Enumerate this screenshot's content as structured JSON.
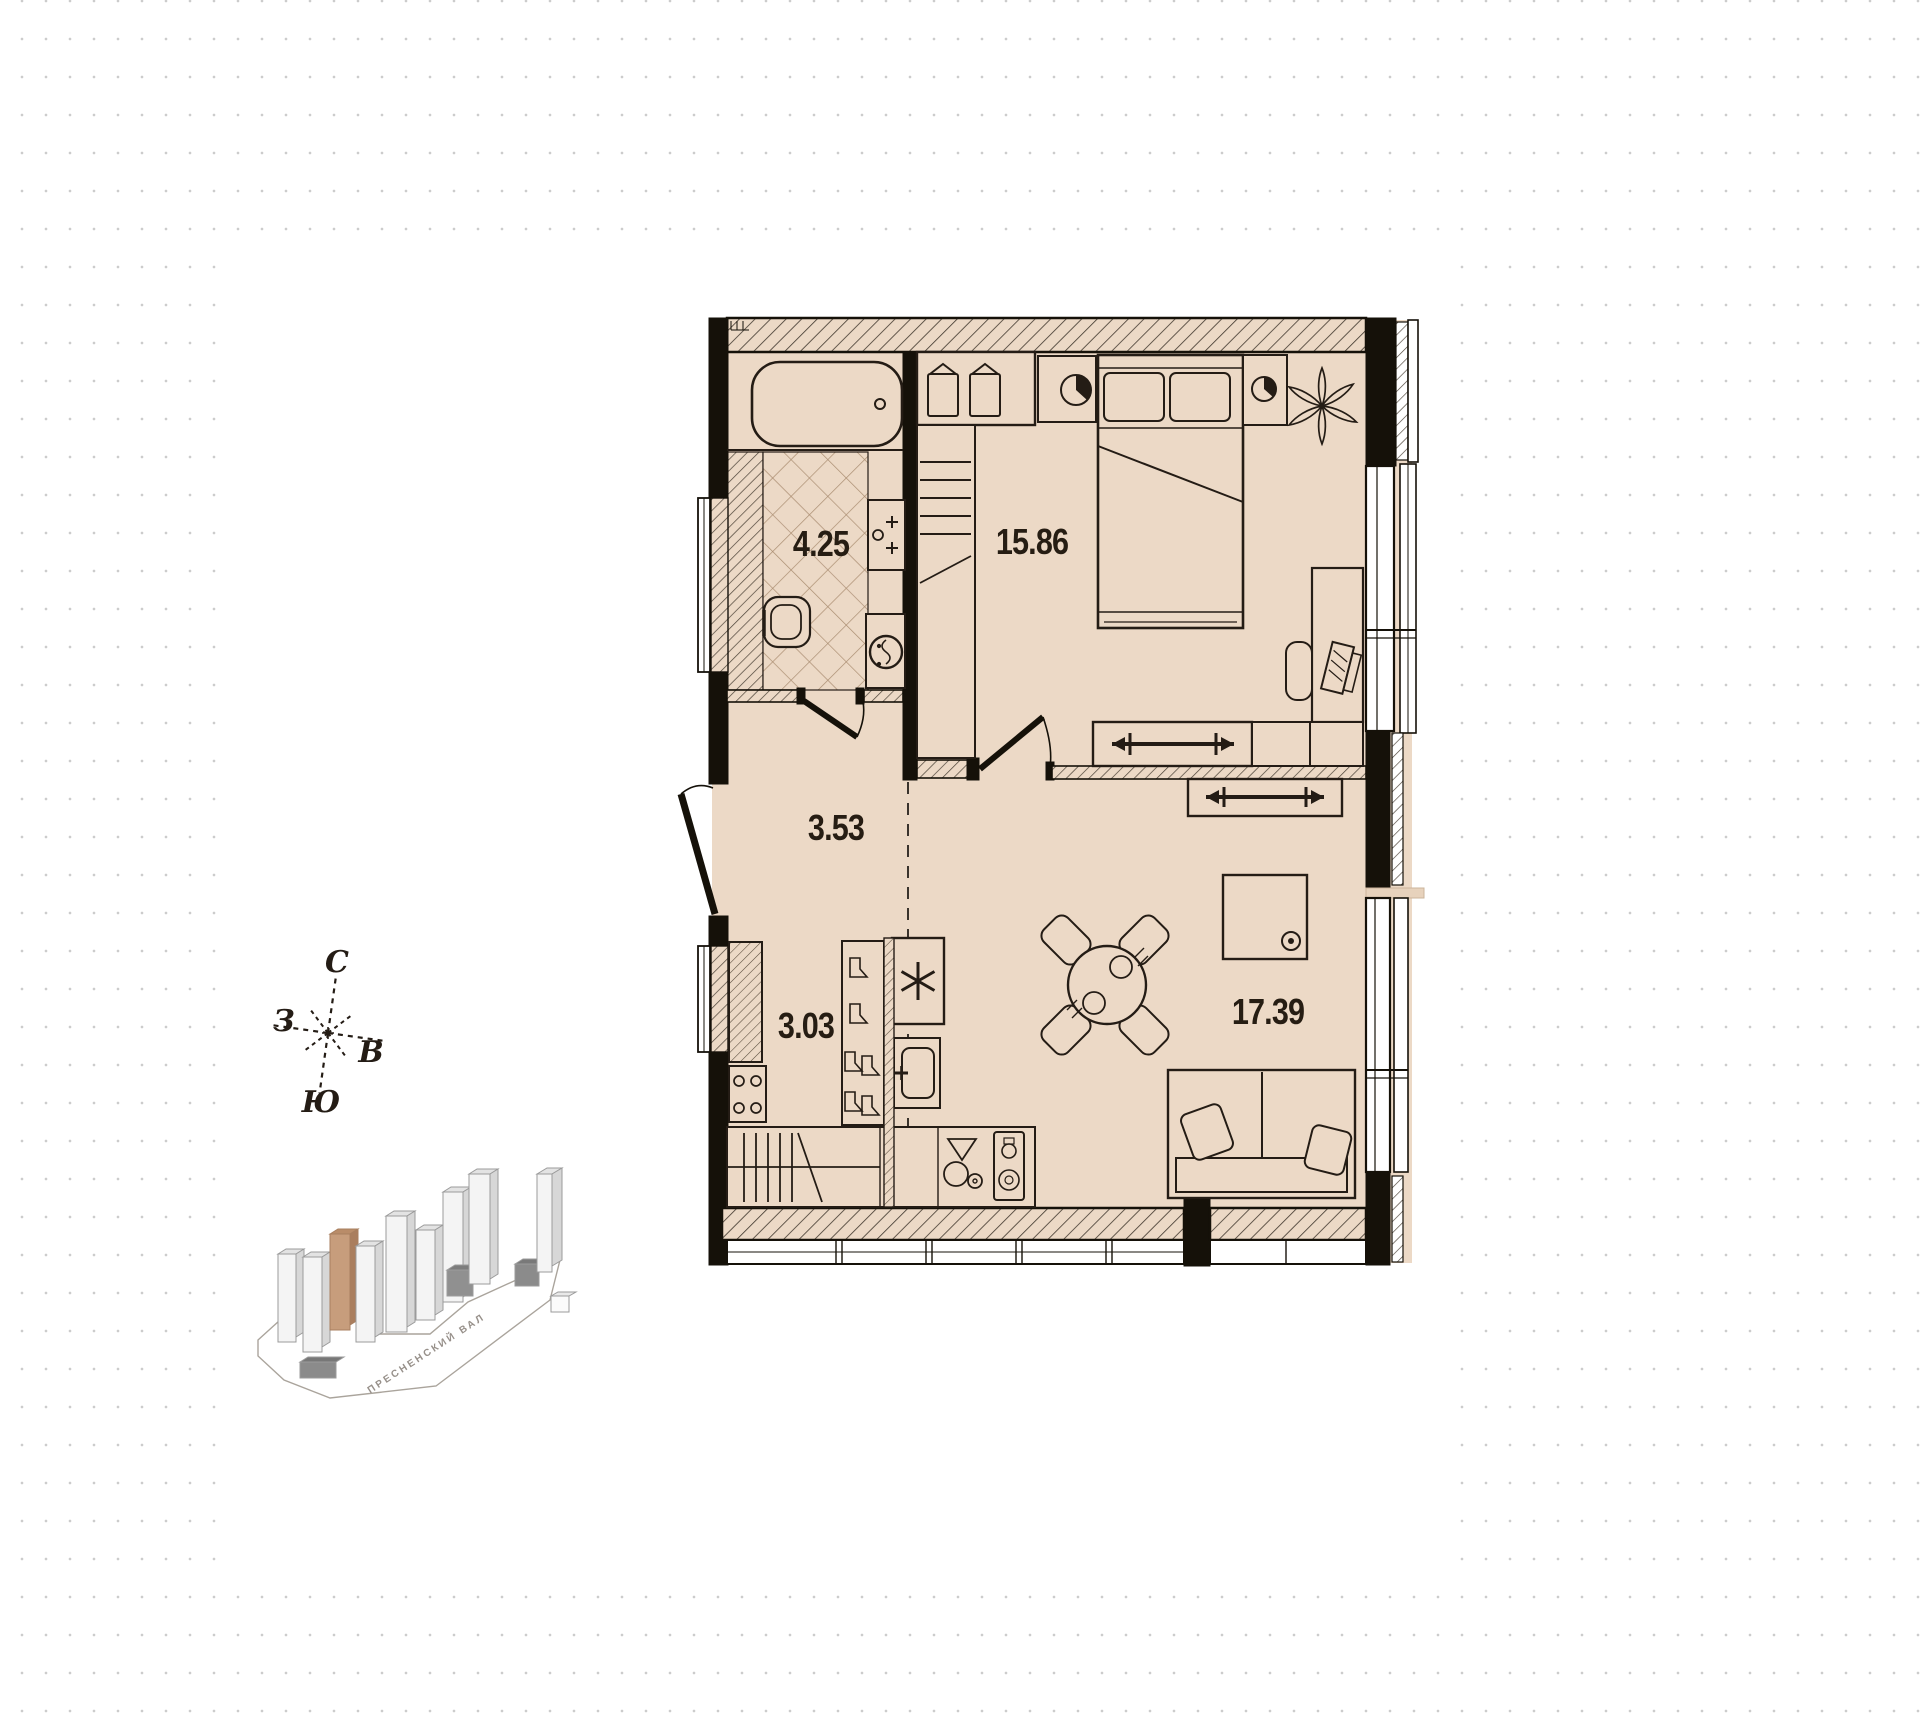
{
  "palette": {
    "floor": "#ecd9c6",
    "wall_ink": "#151109",
    "line_ink": "#241c15",
    "tile_line": "#ab8e72",
    "dot_grid": "#cccccc",
    "highlight_building": "#c79d7c"
  },
  "floor_plan": {
    "rooms": [
      {
        "name": "bathroom",
        "area": "4.25"
      },
      {
        "name": "bedroom",
        "area": "15.86"
      },
      {
        "name": "hallway",
        "area": "3.53"
      },
      {
        "name": "kitchen",
        "area": "3.03"
      },
      {
        "name": "living-room",
        "area": "17.39"
      }
    ]
  },
  "compass": {
    "north": "С",
    "west": "З",
    "east": "В",
    "south": "Ю"
  },
  "location_map": {
    "street_label": "ПРЕСНЕНСКИЙ ВАЛ"
  }
}
